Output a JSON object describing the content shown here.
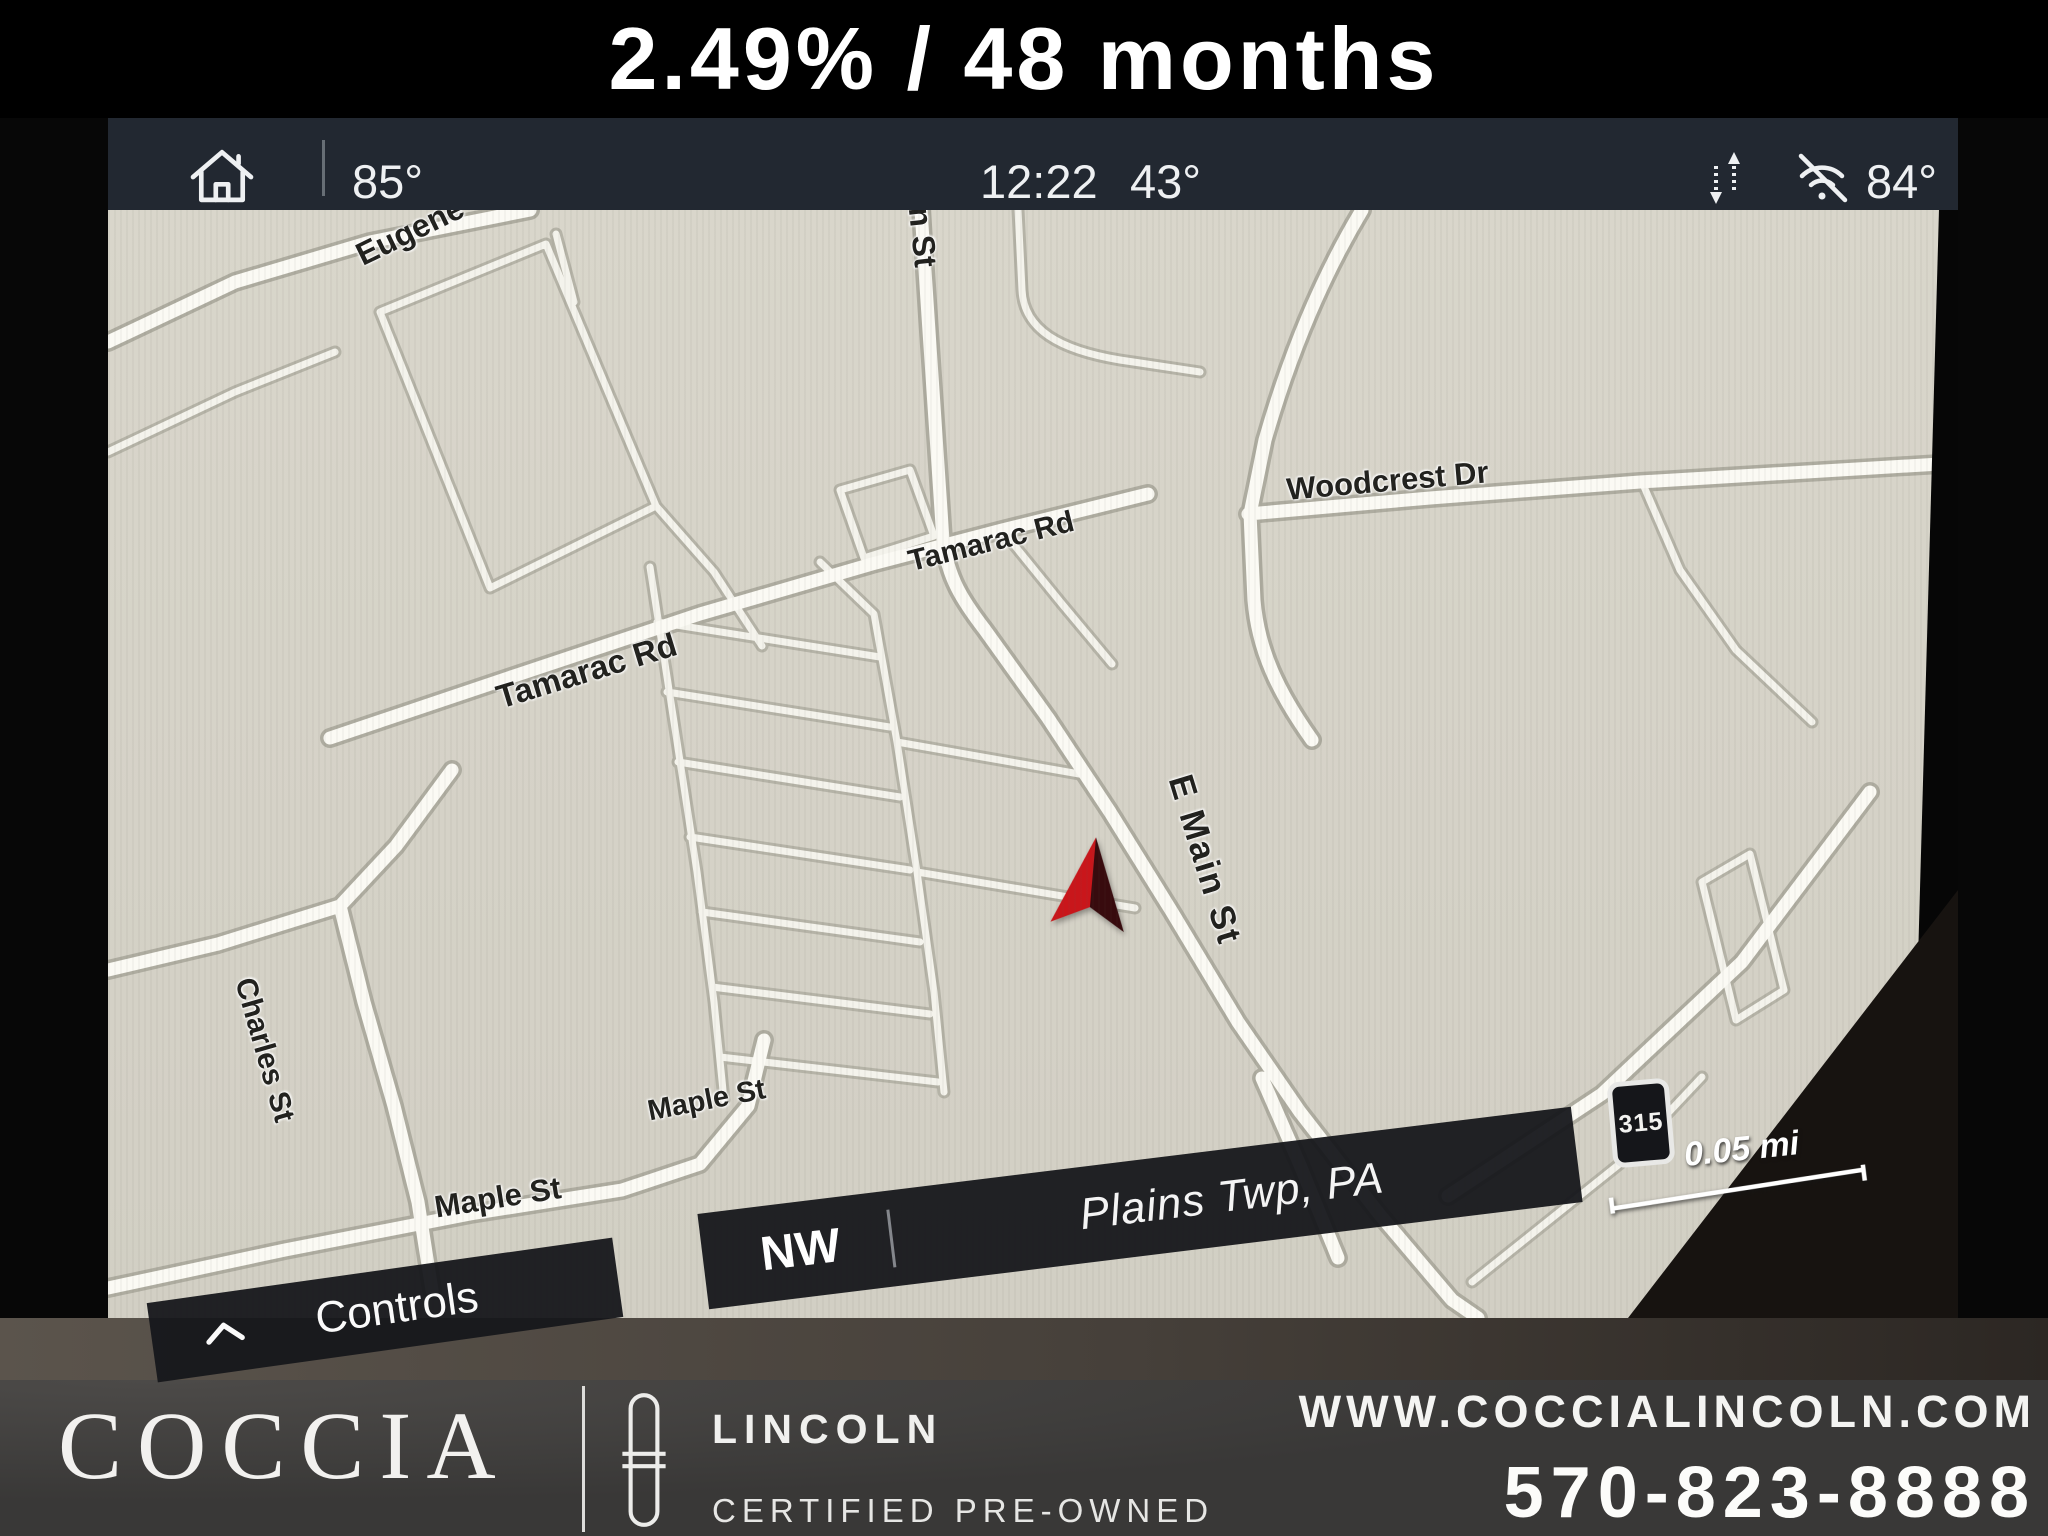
{
  "banner": {
    "offer": "2.49% / 48 months"
  },
  "status_bar": {
    "driver_temp": "85°",
    "time": "12:22",
    "outside_temp": "43°",
    "passenger_temp": "84°"
  },
  "map": {
    "street_labels": [
      "Eugene",
      "Main St",
      "Woodcrest Dr",
      "Tamarac Rd",
      "Tamarac Rd",
      "E Main St",
      "Charles St",
      "Maple St",
      "Maple St"
    ],
    "route_shield": "315",
    "scale_label": "0.05 mi",
    "compass_heading": "NW",
    "current_location": "Plains Twp, PA",
    "controls_label": "Controls"
  },
  "footer": {
    "dealer_name": "COCCIA",
    "brand": "LINCOLN",
    "program": "CERTIFIED PRE-OWNED",
    "website": "WWW.COCCIALINCOLN.COM",
    "phone": "570-823-8888"
  },
  "icons": {
    "home": "home-icon",
    "data_transfer": "updown-arrows-icon",
    "wifi": "wifi-off-icon",
    "chevron": "chevron-up-icon",
    "vehicle_marker": "nav-arrow-icon",
    "lincoln": "lincoln-star-icon"
  },
  "colors": {
    "banner_bg": "#000000",
    "statusbar_bg": "#222831",
    "map_bg": "#d8d5ca",
    "overlay_bar_bg": "#17181c",
    "marker_red": "#c9161b",
    "marker_dark": "#380b0e",
    "footer_bg": "#393837",
    "text_light": "#f2f3f4",
    "map_text": "#21211e"
  }
}
